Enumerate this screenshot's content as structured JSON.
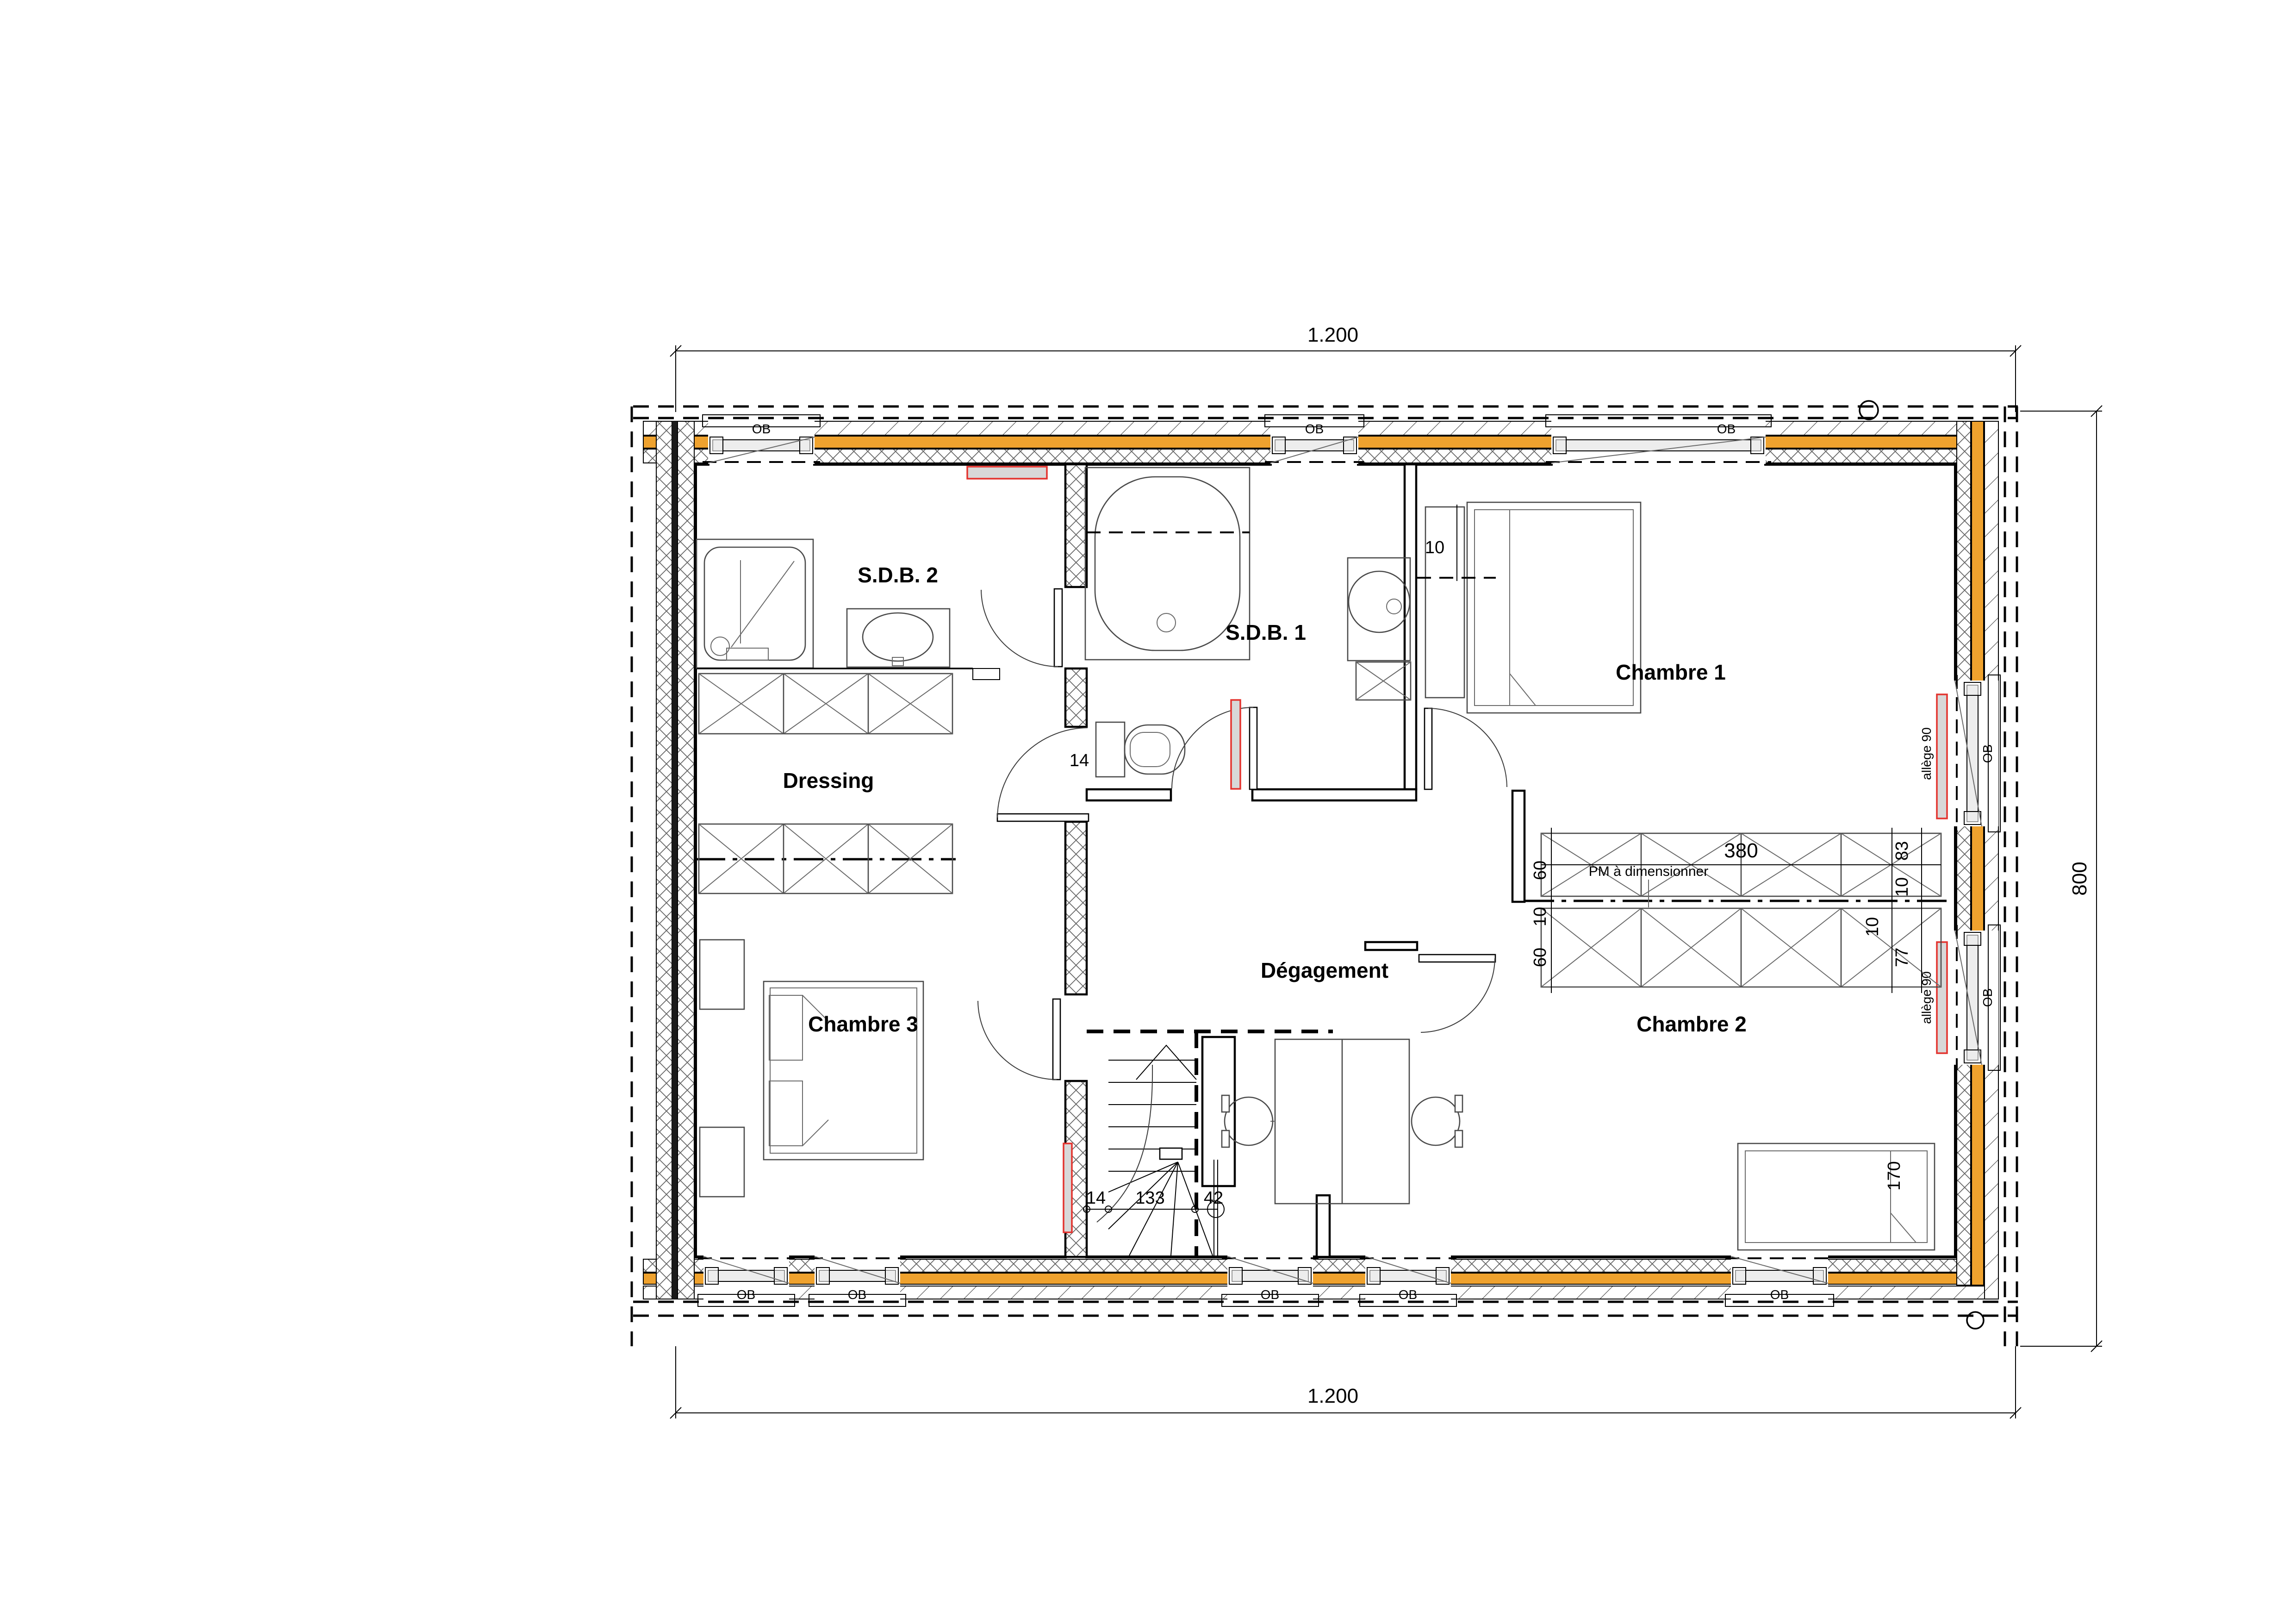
{
  "plan": {
    "rooms": [
      {
        "id": "sdb2",
        "label": "S.D.B. 2"
      },
      {
        "id": "sdb1",
        "label": "S.D.B. 1"
      },
      {
        "id": "chambre1",
        "label": "Chambre 1"
      },
      {
        "id": "dressing",
        "label": "Dressing"
      },
      {
        "id": "degagement",
        "label": "Dégagement"
      },
      {
        "id": "chambre2",
        "label": "Chambre 2"
      },
      {
        "id": "chambre3",
        "label": "Chambre 3"
      }
    ],
    "dimensions": {
      "overall_width_top": "1.200",
      "overall_width_bottom": "1.200",
      "overall_height_right": "800",
      "chambre1_wall_thickness": "10",
      "sdb_wall_thickness": "14",
      "stair_wall": "14",
      "stair_run": "133",
      "stair_exit": "42",
      "closet_top_depth": "60",
      "closet_top_length": "380",
      "closet_top_right_width": "83",
      "closet_top_partition": "10",
      "closet_bottom_partition_left": "10",
      "closet_bottom_depth": "60",
      "closet_bottom_partition_right": "10",
      "closet_bottom_right_width": "77",
      "bed_length": "170"
    },
    "annotations": {
      "closet_note": "PM à dimensionner",
      "window_sill": "allège 90",
      "window_label": "OB"
    },
    "colors": {
      "wall_fill": "#EFA22E",
      "radiator_outline": "#E3342F",
      "radiator_fill": "#D8D8D8",
      "line": "#000000"
    }
  }
}
